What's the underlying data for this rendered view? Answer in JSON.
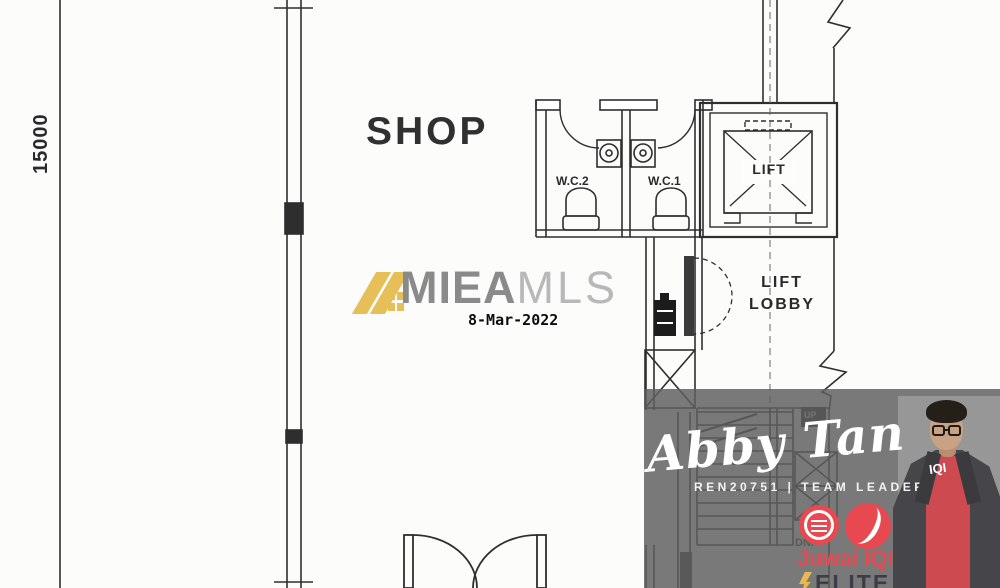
{
  "floor_plan": {
    "dimension": "15000",
    "shop": "SHOP",
    "wc2": "W.C.2",
    "wc1": "W.C.1",
    "lift": "LIFT",
    "lobby_line1": "LIFT",
    "lobby_line2": "LOBBY",
    "stair_up": "UP",
    "stair_down": "DN.",
    "line_color": "#2e2e2e"
  },
  "watermark": {
    "brand_bold": "MIEA",
    "brand_light": "MLS",
    "date_stamp": "8-Mar-2022",
    "logo_yellow": "#e7bf58",
    "brand_bold_color": "#8a8a8a",
    "brand_light_color": "#b8b8b8"
  },
  "agent_overlay": {
    "name": "Abby Tan",
    "credentials": "REN20751 | TEAM LEADER",
    "company": "Juwai IQI",
    "tier": "ELITE",
    "shirt_text": "IQI",
    "accent_red": "#e8484f",
    "band_gray": "#5f5f5f",
    "photo_backdrop_gray": "#979797"
  }
}
